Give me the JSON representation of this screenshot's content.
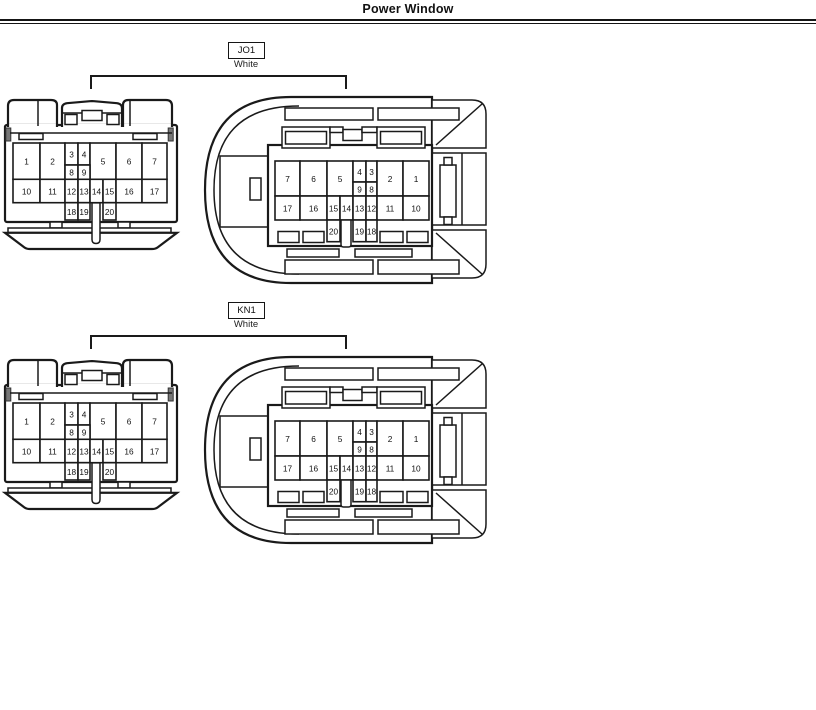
{
  "page": {
    "title": "Power Window"
  },
  "groups": [
    {
      "code": "JO1",
      "color": "White"
    },
    {
      "code": "KN1",
      "color": "White"
    }
  ],
  "connector": {
    "views": {
      "front": {
        "description": "connector front view pin cavity map",
        "pins": [
          {
            "n": "1",
            "x": 11,
            "y": 46,
            "w": 27,
            "h": 36.3
          },
          {
            "n": "2",
            "x": 38,
            "y": 46,
            "w": 25,
            "h": 36.3
          },
          {
            "n": "3",
            "x": 63,
            "y": 46,
            "w": 13,
            "h": 22
          },
          {
            "n": "4",
            "x": 76,
            "y": 46,
            "w": 12,
            "h": 22
          },
          {
            "n": "5",
            "x": 88,
            "y": 46,
            "w": 26,
            "h": 36.3
          },
          {
            "n": "6",
            "x": 114,
            "y": 46,
            "w": 26,
            "h": 36.3
          },
          {
            "n": "7",
            "x": 140,
            "y": 46,
            "w": 25,
            "h": 36.3
          },
          {
            "n": "8",
            "x": 63,
            "y": 68,
            "w": 13,
            "h": 14.3
          },
          {
            "n": "9",
            "x": 76,
            "y": 68,
            "w": 12,
            "h": 14.3
          },
          {
            "n": "10",
            "x": 11,
            "y": 82.3,
            "w": 27,
            "h": 23.4
          },
          {
            "n": "11",
            "x": 38,
            "y": 82.3,
            "w": 25,
            "h": 23.4
          },
          {
            "n": "12",
            "x": 63,
            "y": 82.3,
            "w": 13,
            "h": 23.4
          },
          {
            "n": "13",
            "x": 76,
            "y": 82.3,
            "w": 12,
            "h": 23.4
          },
          {
            "n": "14",
            "x": 88,
            "y": 82.3,
            "w": 13,
            "h": 23.4
          },
          {
            "n": "15",
            "x": 101,
            "y": 82.3,
            "w": 13,
            "h": 23.4
          },
          {
            "n": "16",
            "x": 114,
            "y": 82.3,
            "w": 26,
            "h": 23.4
          },
          {
            "n": "17",
            "x": 140,
            "y": 82.3,
            "w": 25,
            "h": 23.4
          },
          {
            "n": "18",
            "x": 63,
            "y": 105.7,
            "w": 13,
            "h": 17.3
          },
          {
            "n": "19",
            "x": 76,
            "y": 105.7,
            "w": 12,
            "h": 17.3
          },
          {
            "n": "20",
            "x": 101,
            "y": 105.7,
            "w": 13,
            "h": 17.3
          }
        ]
      },
      "rear": {
        "description": "connector rear view pin cavity map (mirrored)",
        "pins": [
          {
            "n": "7",
            "x": 72,
            "y": 66,
            "w": 25,
            "h": 35
          },
          {
            "n": "6",
            "x": 97,
            "y": 66,
            "w": 27,
            "h": 35
          },
          {
            "n": "5",
            "x": 124,
            "y": 66,
            "w": 26,
            "h": 35
          },
          {
            "n": "4",
            "x": 150,
            "y": 66,
            "w": 13,
            "h": 21
          },
          {
            "n": "3",
            "x": 163,
            "y": 66,
            "w": 11,
            "h": 21
          },
          {
            "n": "9",
            "x": 150,
            "y": 87,
            "w": 13,
            "h": 14
          },
          {
            "n": "8",
            "x": 163,
            "y": 87,
            "w": 11,
            "h": 14
          },
          {
            "n": "2",
            "x": 174,
            "y": 66,
            "w": 26,
            "h": 35
          },
          {
            "n": "1",
            "x": 200,
            "y": 66,
            "w": 26,
            "h": 35
          },
          {
            "n": "17",
            "x": 72,
            "y": 101,
            "w": 25,
            "h": 24
          },
          {
            "n": "16",
            "x": 97,
            "y": 101,
            "w": 27,
            "h": 24
          },
          {
            "n": "15",
            "x": 124,
            "y": 101,
            "w": 13,
            "h": 24
          },
          {
            "n": "14",
            "x": 137,
            "y": 101,
            "w": 13,
            "h": 24
          },
          {
            "n": "13",
            "x": 150,
            "y": 101,
            "w": 13,
            "h": 24
          },
          {
            "n": "12",
            "x": 163,
            "y": 101,
            "w": 11,
            "h": 24
          },
          {
            "n": "11",
            "x": 174,
            "y": 101,
            "w": 26,
            "h": 24
          },
          {
            "n": "10",
            "x": 200,
            "y": 101,
            "w": 26,
            "h": 24
          },
          {
            "n": "20",
            "x": 124,
            "y": 125,
            "w": 13,
            "h": 21.7
          },
          {
            "n": "19",
            "x": 150,
            "y": 125,
            "w": 13,
            "h": 21.7
          },
          {
            "n": "18",
            "x": 163,
            "y": 125,
            "w": 11,
            "h": 21.7
          }
        ]
      }
    }
  }
}
